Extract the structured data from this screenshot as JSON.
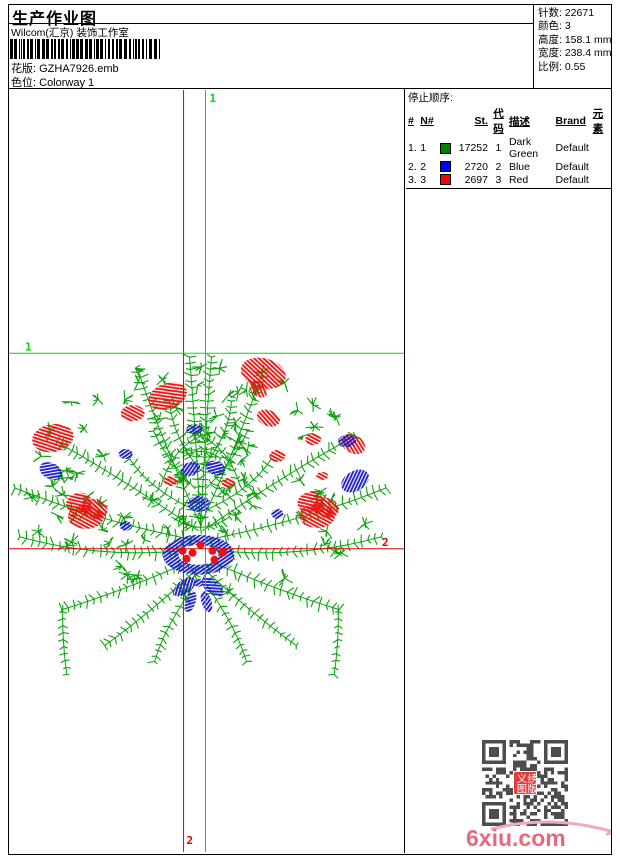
{
  "header": {
    "title": "生产作业图",
    "studio": "Wilcom(汇京) 装饰工作室",
    "pattern_label": "花版:",
    "pattern_value": "GZHA7926.emb",
    "colorway_label": "色位:",
    "colorway_value": "Colorway 1"
  },
  "info": {
    "rows": [
      {
        "label": "针数:",
        "value": "22671"
      },
      {
        "label": "颜色:",
        "value": "3"
      },
      {
        "label": "高度:",
        "value": "158.1 mm"
      },
      {
        "label": "宽度:",
        "value": "238.4 mm"
      },
      {
        "label": "比例:",
        "value": "0.55"
      }
    ]
  },
  "stop_sequence": {
    "title": "停止顺序:",
    "columns": {
      "hash": "#",
      "n": "N#",
      "st": "St.",
      "code": "代码",
      "desc": "描述",
      "brand": "Brand",
      "element": "元素"
    },
    "rows": [
      {
        "index": "1.",
        "n": "1",
        "swatch": "#008000",
        "st": "17252",
        "code": "1",
        "desc": "Dark Green",
        "brand": "Default",
        "element": ""
      },
      {
        "index": "2.",
        "n": "2",
        "swatch": "#0000ff",
        "st": "2720",
        "code": "2",
        "desc": "Blue",
        "brand": "Default",
        "element": ""
      },
      {
        "index": "3.",
        "n": "3",
        "swatch": "#ff0000",
        "st": "2697",
        "code": "3",
        "desc": "Red",
        "brand": "Default",
        "element": ""
      }
    ]
  },
  "design": {
    "colors": {
      "green": "#0ca10c",
      "red": "#ee1212",
      "blue": "#2020cc",
      "cross_green": "#00dd00",
      "cross_red": "#e00000"
    },
    "markers": {
      "top": "1",
      "left": "1",
      "right": "2",
      "bottom": "2"
    },
    "crosshair": {
      "red_v_x": 175,
      "green_v_x": 197,
      "green_h_y": 264,
      "red_h_y": 460
    },
    "red_blobs": [
      [
        159,
        307,
        20,
        13,
        -20
      ],
      [
        255,
        284,
        23,
        15,
        15
      ],
      [
        124,
        324,
        12,
        8,
        0
      ],
      [
        44,
        349,
        21,
        14,
        -10
      ],
      [
        260,
        329,
        12,
        8,
        20
      ],
      [
        305,
        350,
        8,
        6,
        0
      ],
      [
        345,
        355,
        13,
        9,
        30
      ],
      [
        250,
        300,
        10,
        7,
        40
      ],
      [
        70,
        414,
        13,
        10,
        -15
      ],
      [
        86,
        420,
        13,
        10,
        15
      ],
      [
        77,
        428,
        18,
        12,
        0
      ],
      [
        302,
        413,
        13,
        10,
        -15
      ],
      [
        318,
        419,
        13,
        10,
        15
      ],
      [
        309,
        427,
        18,
        12,
        0
      ],
      [
        269,
        367,
        8,
        6,
        0
      ],
      [
        162,
        392,
        7,
        5,
        0
      ],
      [
        220,
        394,
        7,
        5,
        0
      ],
      [
        314,
        387,
        6,
        4,
        0
      ]
    ],
    "blue_blobs": [
      [
        182,
        380,
        10,
        7,
        -20
      ],
      [
        207,
        379,
        10,
        7,
        20
      ],
      [
        117,
        365,
        7,
        5,
        0
      ],
      [
        339,
        352,
        9,
        6,
        0
      ],
      [
        347,
        392,
        15,
        10,
        -30
      ],
      [
        42,
        382,
        12,
        8,
        25
      ],
      [
        190,
        415,
        11,
        8,
        0
      ],
      [
        269,
        425,
        6,
        5,
        0
      ],
      [
        117,
        437,
        6,
        5,
        0
      ],
      [
        186,
        340,
        8,
        5,
        0
      ]
    ],
    "bow": [
      [
        176,
        498,
        13,
        7,
        -38
      ],
      [
        204,
        498,
        13,
        7,
        38
      ],
      [
        182,
        513,
        5,
        11,
        18
      ],
      [
        198,
        513,
        5,
        11,
        -18
      ],
      [
        190,
        494,
        5,
        4,
        0
      ]
    ],
    "red_dots": [
      [
        174,
        462
      ],
      [
        184,
        464
      ],
      [
        204,
        462
      ],
      [
        214,
        464
      ],
      [
        178,
        470
      ],
      [
        206,
        471
      ],
      [
        192,
        456
      ]
    ]
  },
  "qr": {
    "logo_chars": [
      "义",
      "绣",
      "图",
      "版"
    ],
    "logo_color": "#e23c3c",
    "module_color": "#4d4d4d"
  },
  "watermark": {
    "text": "6xiu.com",
    "color": "#e8697a",
    "swoosh_color": "#f2aab6"
  }
}
